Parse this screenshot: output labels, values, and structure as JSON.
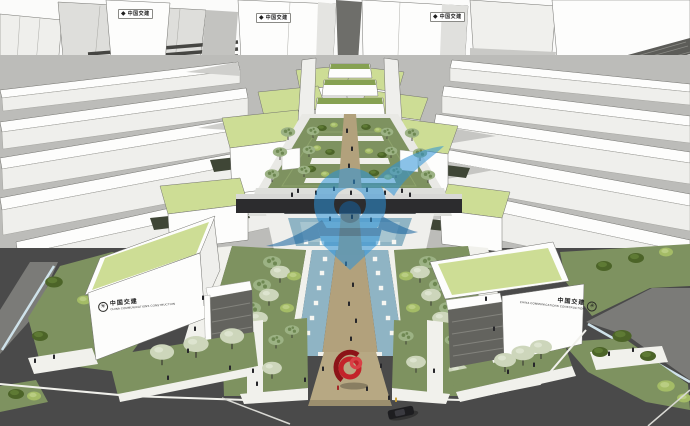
{
  "scene": {
    "type": "3d-architectural-rendering",
    "description": "Aerial SketchUp-style rendering of a symmetric office campus: white slab buildings with light-green roofs flanking a central landscaped pedestrian axis with sunken gardens, a water channel with stepping stones, a crossing sky-bridge, a red ribbon sculpture at the entry plaza, perimeter roads with a car and pedestrians, and a semi-transparent blue corporate logo watermark over the center.",
    "watermark": "blue swirl-and-arrow corporate logo",
    "signs": {
      "tower_logo_glyph": "◆",
      "front_logo_glyph": "✳",
      "tower_sign_left": "中国交建",
      "tower_sign_center": "中国交建",
      "tower_sign_right": "中国交建",
      "front_left_main": "中国交建",
      "front_left_sub": "CHINA COMMUNICATIONS CONSTRUCTION",
      "front_right_main": "中国交建",
      "front_right_sub": "CHINA COMMUNICATIONS CONSTRUCTION"
    }
  },
  "colors": {
    "building_white": "#fdfdfc",
    "building_light": "#efefec",
    "building_mid": "#d9d9d6",
    "building_dark": "#b9b9b6",
    "louver": "#63635e",
    "slot": "#6e6e6a",
    "edge": "#73736f",
    "green_roof": "#cddd95",
    "planter_green": "#86a152",
    "lawn": "#7e9260",
    "lawn_light": "#93a873",
    "bush_dark": "#4c6428",
    "bush_light": "#a4bc66",
    "tree_sage": "#9cb284",
    "tree_sage_dark": "#6e8852",
    "tree_pale": "#cdd6bb",
    "trunk": "#3b3b33",
    "path_tan": "#b2a17c",
    "plaza_tan": "#b7a883",
    "water": "#8fb4c4",
    "water_light": "#a7c5d0",
    "road": "#4a4a4a",
    "road_light": "#7b7b78",
    "sidewalk": "#f1f1ec",
    "curb_blue": "#cfe2ea",
    "bridge": "#2c2c2e",
    "bridge_rail": "#d8d8d6",
    "stone": "#f6f6f2",
    "watermark": "#2d93d8",
    "watermark_dark": "#15629f",
    "sculpture_red": "#c3232a",
    "sculpture_red_dark": "#8c1318",
    "person": "#26262a",
    "person_accent": "#c9a23b",
    "car_body": "#1d1d20",
    "sign_text": "#1f1f1f"
  }
}
